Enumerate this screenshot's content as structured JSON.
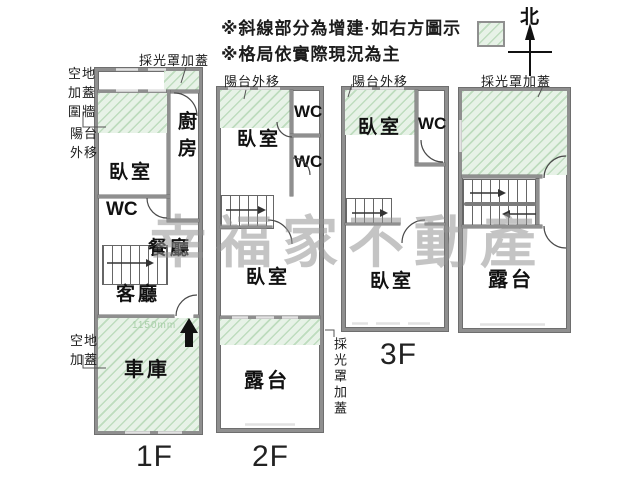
{
  "notes": {
    "line1": "※斜線部分為增建·如右方圖示",
    "line2": "※格局依實際現況為主"
  },
  "compass": {
    "label": "北"
  },
  "watermark": {
    "text": "幸福家不動產"
  },
  "colors": {
    "hatch_bg": "#e7f2e7",
    "hatch_line": "#bedcbe",
    "wall": "#8f8f8f",
    "wall_edge": "#6e6e6e",
    "text": "#111111",
    "note_text": "#1c1c1c",
    "watermark": "#949494",
    "dim_text": "#a9cfa9"
  },
  "floor1": {
    "floor_label": "1F",
    "annotations": {
      "skylight_top": "採光罩加蓋",
      "wall_note_lines": [
        "空地",
        "加蓋",
        "圍牆"
      ],
      "balcony_note_lines": [
        "陽台",
        "外移"
      ],
      "yard_note_lines": [
        "空地",
        "加蓋"
      ],
      "dim": "1150mm"
    },
    "rooms": {
      "bedroom": "臥室",
      "kitchen": "廚房",
      "wc": "WC",
      "dining": "餐廳",
      "living": "客廳",
      "garage": "車庫"
    }
  },
  "floor2": {
    "floor_label": "2F",
    "annotations": {
      "balcony_note": "陽台外移",
      "skylight_right": "採光罩加蓋"
    },
    "rooms": {
      "bedroom_front": "臥室",
      "wc_upper": "WC",
      "wc_lower": "WC",
      "bedroom_rear": "臥室",
      "terrace": "露台"
    }
  },
  "floor3": {
    "floor_label": "3F",
    "annotations": {
      "balcony_note": "陽台外移"
    },
    "rooms": {
      "bedroom_front": "臥室",
      "wc": "WC",
      "bedroom_rear": "臥室"
    }
  },
  "roof": {
    "annotations": {
      "skylight_top": "採光罩加蓋"
    },
    "rooms": {
      "terrace": "露台"
    }
  }
}
